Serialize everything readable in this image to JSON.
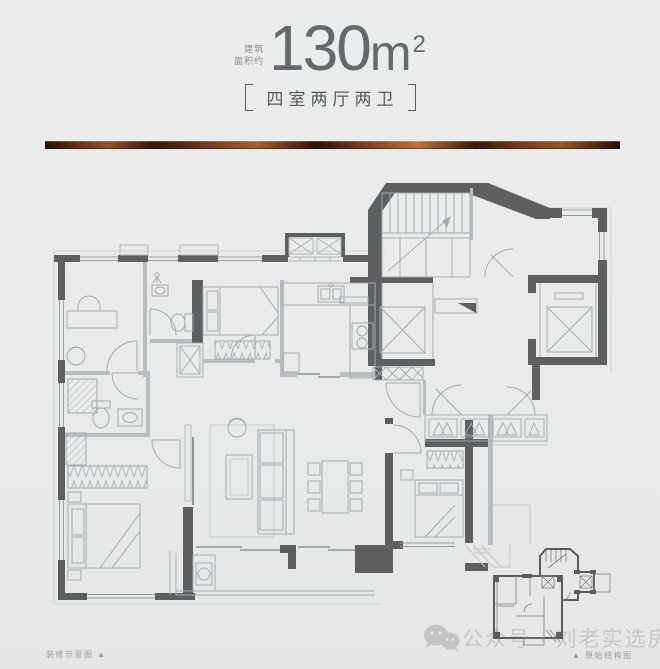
{
  "header": {
    "area_prefix_line1": "建筑",
    "area_prefix_line2": "面积约",
    "area_value": "130",
    "area_unit": "m",
    "area_exponent": "2",
    "layout_tag": "四室两厅两卫"
  },
  "footer": {
    "left_caption": "装修示意图",
    "left_marker": "▲",
    "right_marker": "▲",
    "right_caption": "原始结构图",
    "watermark_text": "公众号 · 刘老实选房"
  },
  "colors": {
    "background": "#e9eaea",
    "heading_text": "#66696b",
    "tag_text": "#56595b",
    "wall_dark": "#5d5f60",
    "wall_light": "#b9bdbf",
    "furniture_line": "#a6abaf",
    "divider_copper_dark": "#23110a",
    "divider_copper_mid": "#8a4724",
    "divider_copper_highlight": "#c0703a",
    "watermark": "#c6c8c8",
    "caption_text": "#96989a"
  }
}
